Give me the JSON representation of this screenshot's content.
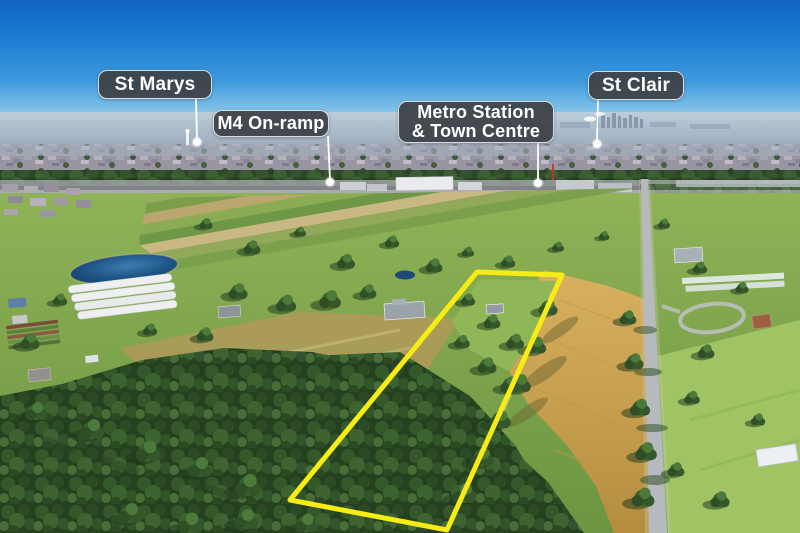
{
  "scene": {
    "kind": "aerial drone photograph of semi-rural acreage with highlighted property boundary",
    "boundary_color": "#F7EC13"
  },
  "callouts": [
    {
      "name": "st-marys",
      "label": "St Marys"
    },
    {
      "name": "m4-on-ramp",
      "label": "M4 On-ramp"
    },
    {
      "name": "metro-station-town-centre",
      "label_line1": "Metro Station",
      "label_line2": "& Town Centre"
    },
    {
      "name": "st-clair",
      "label": "St Clair"
    }
  ],
  "colors": {
    "callout_background": "#3E4247",
    "callout_border": "#F4F7F9",
    "callout_text": "#FFFFFF",
    "leader_line": "#FFFFFF",
    "boundary_yellow": "#F7EC13",
    "sky_top": "#1065C2",
    "sky_horizon": "#B9DCEF"
  }
}
